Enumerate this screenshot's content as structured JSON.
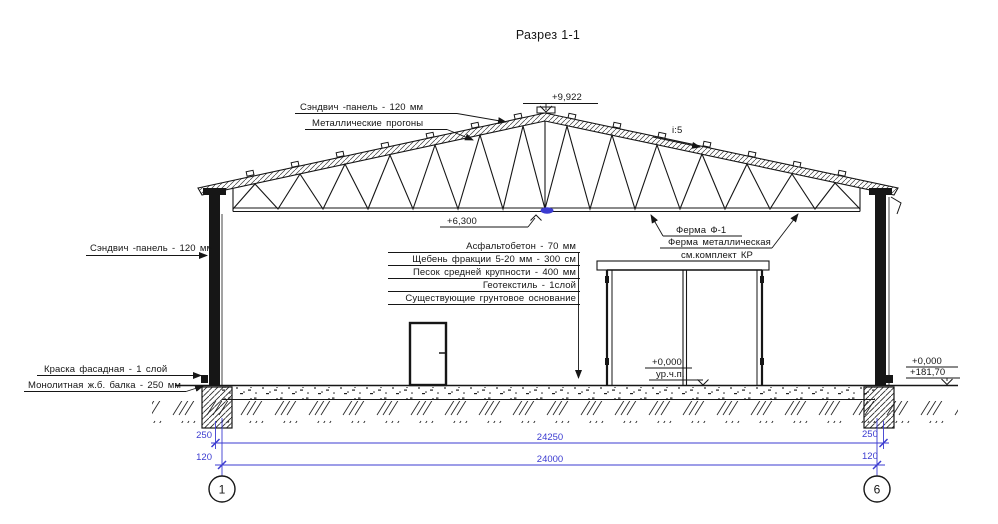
{
  "title": "Разрез 1-1",
  "colors": {
    "line": "#161616",
    "dimension": "#3b3bd0"
  },
  "callouts": {
    "roof_panel": "Сэндвич -панель - 120 мм",
    "roof_purlins": "Металлические прогоны",
    "peak_level": "+9,922",
    "roof_slope": "i:5",
    "chord_level": "+6,300",
    "truss_name": "Ферма Ф-1",
    "truss_material": "Ферма металлическая",
    "truss_ref": "см.комплект КР",
    "wall_panel": "Сэндвич -панель - 120 мм",
    "facade_paint": "Краска фасадная - 1 слой",
    "concrete_beam": "Монолитная ж.б. балка - 250 мм",
    "floor_level": "+0,000",
    "floor_level_note": "ур.ч.п.",
    "datum_relative": "+0,000",
    "datum_absolute": "+181,70"
  },
  "floor_layers": [
    "Асфальтобетон - 70 мм",
    "Щебень фракции 5-20 мм - 300 см",
    "Песок средней крупности - 400 мм",
    "Геотекстиль - 1слой",
    "Существующие грунтовое основание"
  ],
  "dimensions": {
    "overall": "24250",
    "between_axes": "24000",
    "left_offset": "250",
    "left_panel": "120",
    "right_offset": "250",
    "right_panel": "120"
  },
  "grid_axes": {
    "left": "1",
    "right": "6"
  }
}
